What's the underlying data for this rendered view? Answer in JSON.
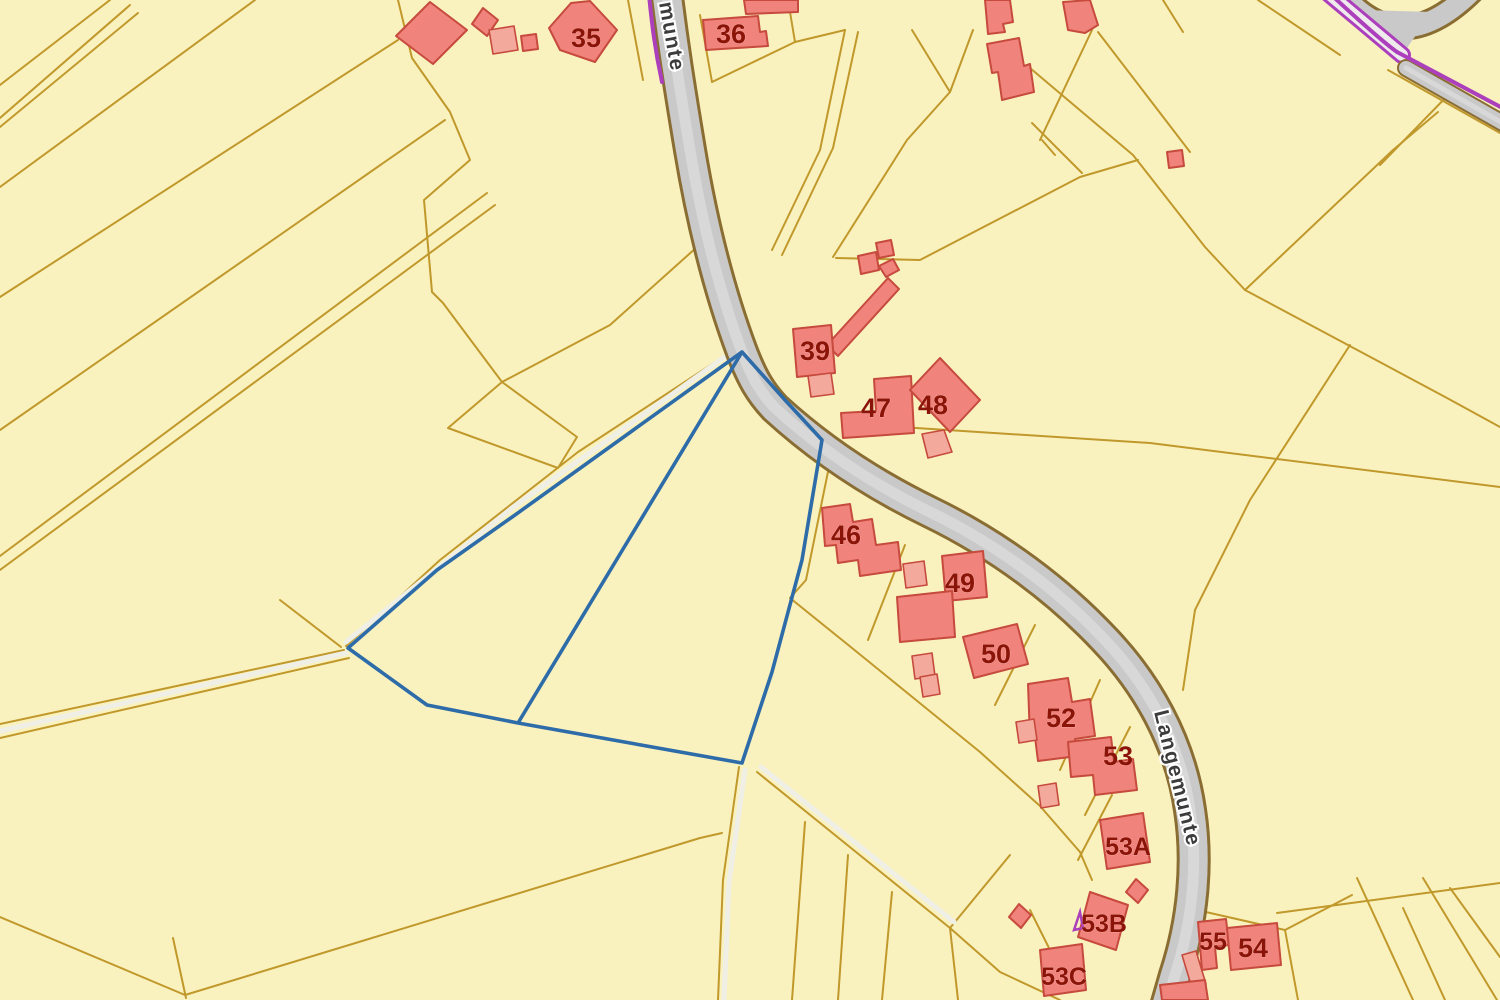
{
  "map": {
    "type": "cadastral-gis-viewer",
    "street_labels": [
      {
        "text": "munte",
        "x": 659,
        "y": 3,
        "rotate": 80,
        "size": 21
      },
      {
        "text": "Langemunte",
        "x": 1154,
        "y": 712,
        "rotate": 76,
        "size": 21
      }
    ],
    "building_labels": [
      {
        "text": "35",
        "x": 586,
        "y": 47,
        "size": 27
      },
      {
        "text": "36",
        "x": 731,
        "y": 43,
        "size": 27
      },
      {
        "text": "39",
        "x": 815,
        "y": 360,
        "size": 27
      },
      {
        "text": "47",
        "x": 876,
        "y": 417,
        "size": 27
      },
      {
        "text": "48",
        "x": 933,
        "y": 414,
        "size": 27
      },
      {
        "text": "46",
        "x": 846,
        "y": 544,
        "size": 27
      },
      {
        "text": "49",
        "x": 960,
        "y": 592,
        "size": 27
      },
      {
        "text": "50",
        "x": 996,
        "y": 663,
        "size": 27
      },
      {
        "text": "52",
        "x": 1061,
        "y": 727,
        "size": 27
      },
      {
        "text": "53",
        "x": 1118,
        "y": 765,
        "size": 27
      },
      {
        "text": "53A",
        "x": 1128,
        "y": 855,
        "size": 25
      },
      {
        "text": "53B",
        "x": 1104,
        "y": 932,
        "size": 25
      },
      {
        "text": "53C",
        "x": 1064,
        "y": 985,
        "size": 25
      },
      {
        "text": "55",
        "x": 1213,
        "y": 950,
        "size": 25
      },
      {
        "text": "54",
        "x": 1253,
        "y": 957,
        "size": 27
      }
    ],
    "colors": {
      "background": "#faf2be",
      "parcel_line": "#c0982b",
      "building_fill": "#f0837b",
      "building_fill_light": "#f3a99c",
      "building_stroke": "#c64a3e",
      "label_text": "#8b1408",
      "street_text": "#3c3c3c",
      "road_casing": "#8a6d33",
      "road_fill": "#c9c9c9",
      "road_mid": "#d8d8d8",
      "selection_blue": "#2d6ca8",
      "boundary_purple": "#ac3fbb",
      "track_white": "#f0efe6"
    }
  }
}
